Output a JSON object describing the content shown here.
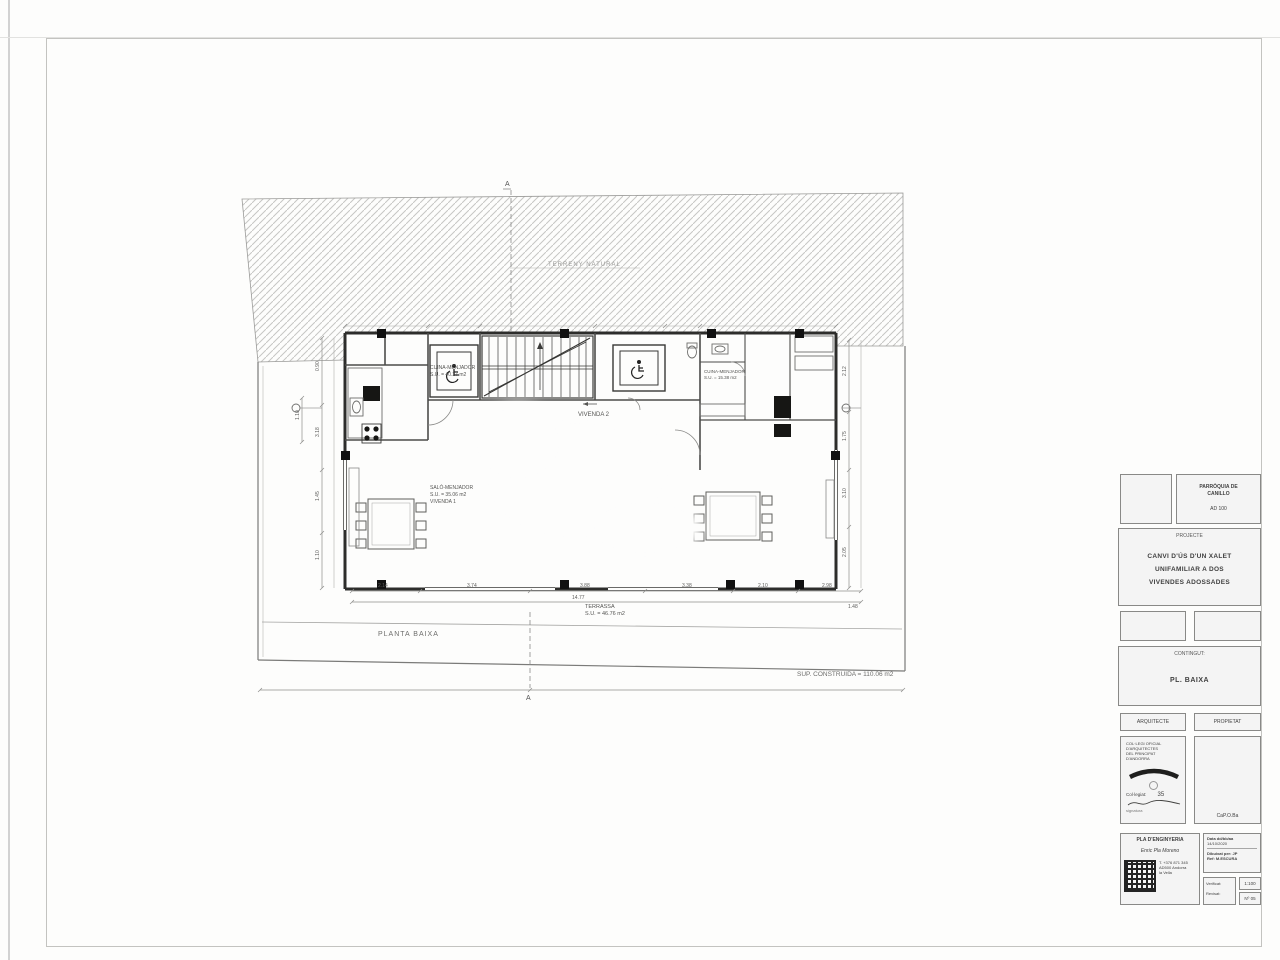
{
  "plan": {
    "terrain_label": "TERRENY NATURAL",
    "section_a_top": "A",
    "section_a_bottom": "A",
    "rooms": {
      "cuina1_l1": "CUINA-MENJADOR",
      "cuina1_l2": "S.U. = 40.27 m2",
      "vivenda2": "VIVENDA 2",
      "salo_l1": "SALÓ-MENJADOR",
      "salo_l2": "S.U. = 35.06 m2",
      "salo_l3": "VIVENDA 1",
      "cuina2_l1": "CUINA-MENJADOR",
      "cuina2_l2": "S.U. = 15.38 m2",
      "terrassa_l1": "TERRASSA",
      "terrassa_l2": "S.U. = 46.76 m2"
    },
    "floor_label": "PLANTA BAIXA",
    "area_label": "SUP. CONSTRUIDA = 110.06 m2",
    "dims_bottom": [
      "2.14",
      "3.74",
      "3.88",
      "3.38",
      "2.10",
      "2.98"
    ],
    "dim_total": "14.77",
    "dim_right_end": "1.48",
    "dims_left": [
      "0.90",
      "3.18",
      "1.45",
      "1.10"
    ],
    "dim_left_extra": "1.10",
    "dims_right": [
      "2.12",
      "1.75",
      "3.10",
      "2.05"
    ]
  },
  "titleblock": {
    "authority": {
      "line1": "PARRÒQUIA DE",
      "line2": "CANILLO",
      "line3": "AD 100"
    },
    "project": {
      "header": "PROJECTE",
      "line1": "CANVI D'ÚS D'UN XALET",
      "line2": "UNIFAMILIAR A DOS",
      "line3": "VIVENDES ADOSSADES"
    },
    "content": {
      "header": "CONTINGUT:",
      "value": "PL. BAIXA"
    },
    "architect": {
      "header": "ARQUITECTE",
      "line1": "COL·LEGI OFICIAL",
      "line2": "D'ARQUITECTES",
      "line3": "DEL PRINCIPAT",
      "line4": "D'ANDORRA",
      "collegiat_label": "Col·legiat:",
      "collegiat_num": "35",
      "signature_note": "signatura"
    },
    "owner": {
      "header": "PROPIETAT",
      "caption": "CaP.O.Ba"
    },
    "firm": {
      "line1": "PLA D'ENGINYERIA",
      "line2": "Enric Pla Moreno",
      "contact1": "T. +376 871 345",
      "contact2": "AD500 Andorra",
      "contact3": "la Vella"
    },
    "meta": {
      "date_label": "Data  dd/bb/aa",
      "date_value": "14/10/2020",
      "drawn_label": "Dibuixat per: JP",
      "ref_label": "Ref: M.ESCURA",
      "verif1": "Verificat:",
      "verif2": "Revisat:",
      "scale": "1:100",
      "number": "Nº 05"
    }
  }
}
